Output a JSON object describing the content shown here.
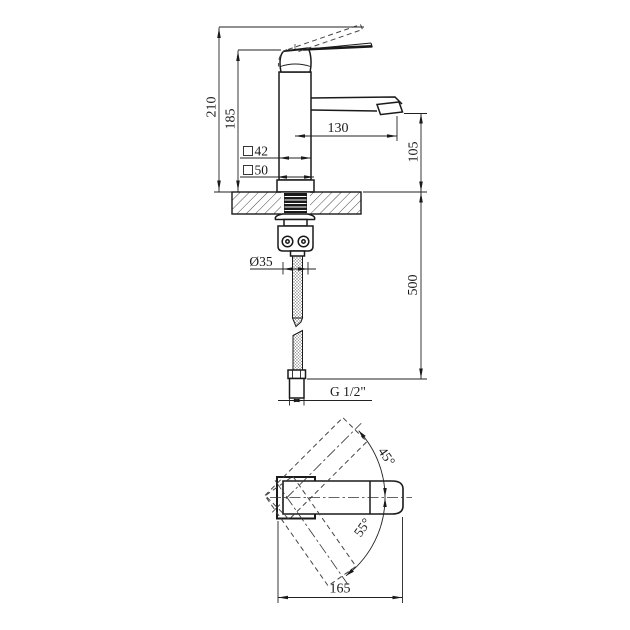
{
  "drawing": {
    "type": "faucet-installation-dimension-drawing",
    "views": {
      "side_view": "faucet side elevation with sink deck and supply hose",
      "plan_view": "handle swing plan view"
    },
    "dimensions": {
      "total_height": "210",
      "body_height": "185",
      "spout_reach": "130",
      "spout_outlet_height": "105",
      "body_section": "42",
      "base_section": "50",
      "section_symbol": "□",
      "mount_hole_diameter": "Ø35",
      "hose_length": "500",
      "thread_size": "G 1/2\"",
      "overall_length": "165",
      "handle_swing_up": "45°",
      "handle_swing_down": "55°"
    },
    "colors": {
      "line": "#1a1a1a",
      "background": "#ffffff",
      "hatch": "#333333",
      "hose_braid": "#808080"
    }
  }
}
